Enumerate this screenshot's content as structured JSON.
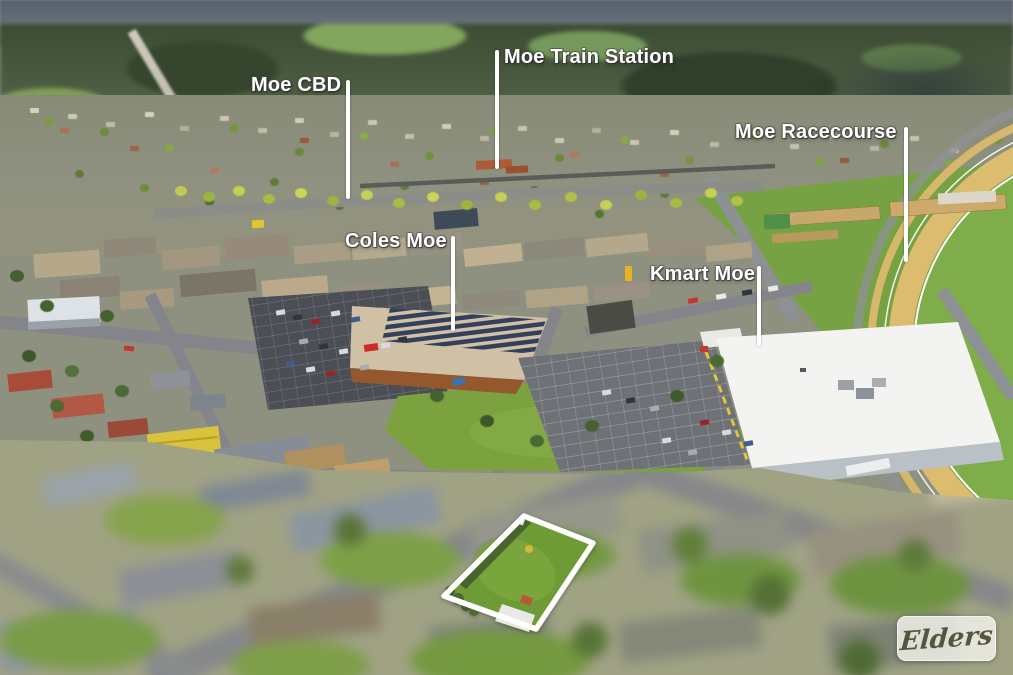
{
  "annotations": {
    "label_text_color": "#ffffff",
    "pointer_line_color": "#ffffff",
    "property_outline_color": "#ffffff",
    "labels": [
      {
        "id": "moe-cbd",
        "text": "Moe CBD"
      },
      {
        "id": "moe-train-station",
        "text": "Moe Train Station"
      },
      {
        "id": "moe-racecourse",
        "text": "Moe Racecourse"
      },
      {
        "id": "coles-moe",
        "text": "Coles Moe"
      },
      {
        "id": "kmart-moe",
        "text": "Kmart Moe"
      }
    ]
  },
  "branding": {
    "logo_text": "Elders",
    "logo_text_color": "#55563f",
    "logo_background": "#f6f6f0"
  },
  "scene": {
    "palette": {
      "racecourse_turf": "#76a244",
      "sand_track": "#dcbc6e",
      "kmart_roof": "#f3f4f1",
      "coles_brick": "#95582c",
      "road_grey": "#85878a",
      "property_grass": "#6f9b37"
    }
  }
}
